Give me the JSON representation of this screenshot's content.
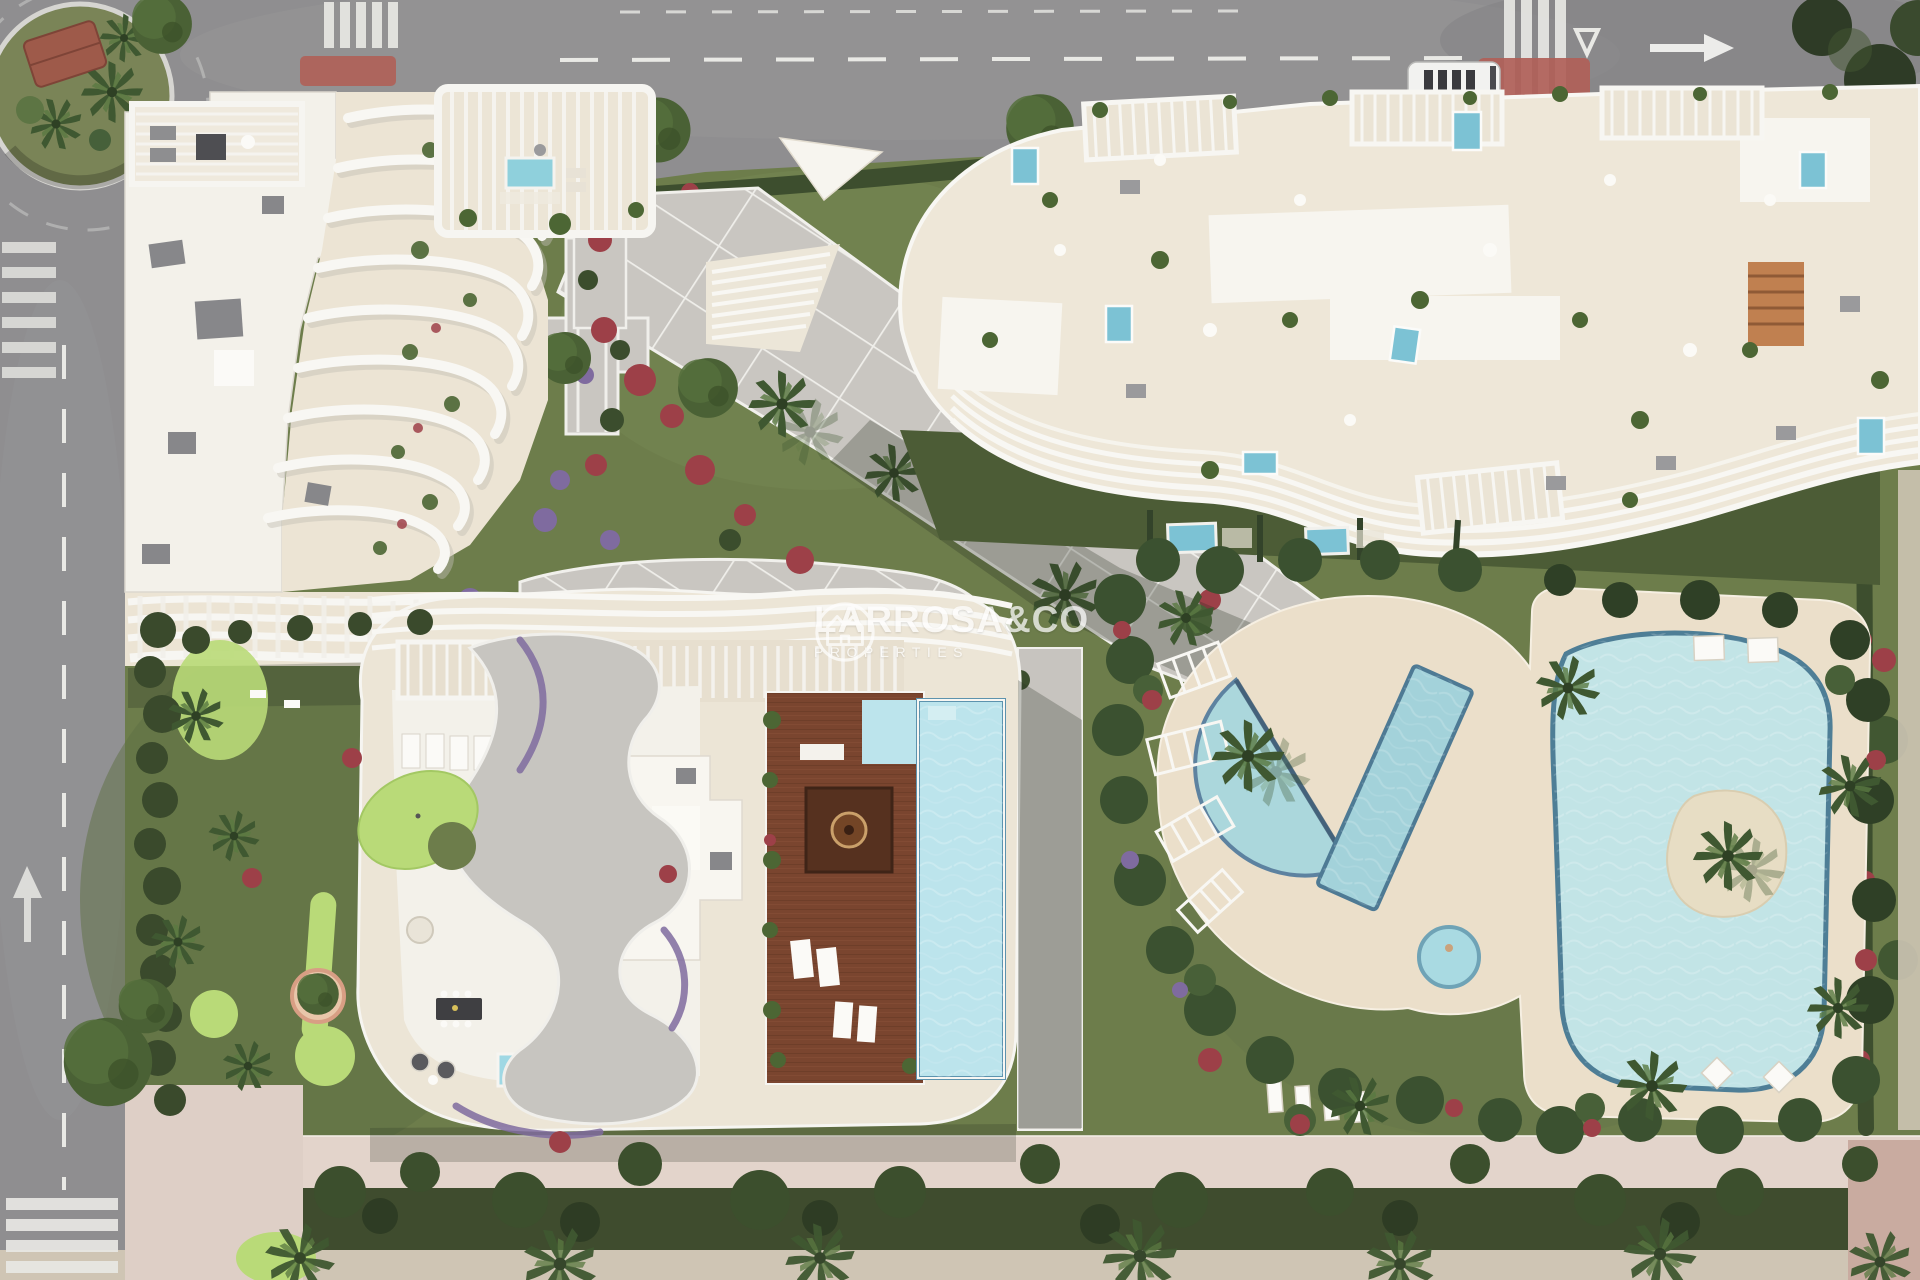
{
  "watermark": {
    "brand": "LARROSA&CO",
    "tagline": "PROPERTIES",
    "logo_icon": "larrosa-house-crown-icon",
    "text_color": "#ffffff",
    "opacity": 0.72
  },
  "palette": {
    "asphalt": "#8f8e90",
    "road_marking": "#e9e9e5",
    "grass": "#6d7d4b",
    "hedge": "#3d4e2e",
    "plaza": "#c9c6c1",
    "plaza_line": "#efeeea",
    "building_white": "#f3f1ea",
    "terrace_cream": "#ece4d4",
    "pool_blue": "#9fd0d8",
    "lagoon_blue": "#c2e4e6",
    "pool_edge": "#4e7e96",
    "deck_wood": "#7a452f",
    "red_flowers": "#9d4048",
    "purple_flowers": "#7f6b9f",
    "putting_green": "#b9da78",
    "sand_path": "#ebdfca",
    "promenade_pink": "#e3d4cb",
    "bottom_road": "#cfc5b4",
    "red_pavement": "#b06058"
  }
}
